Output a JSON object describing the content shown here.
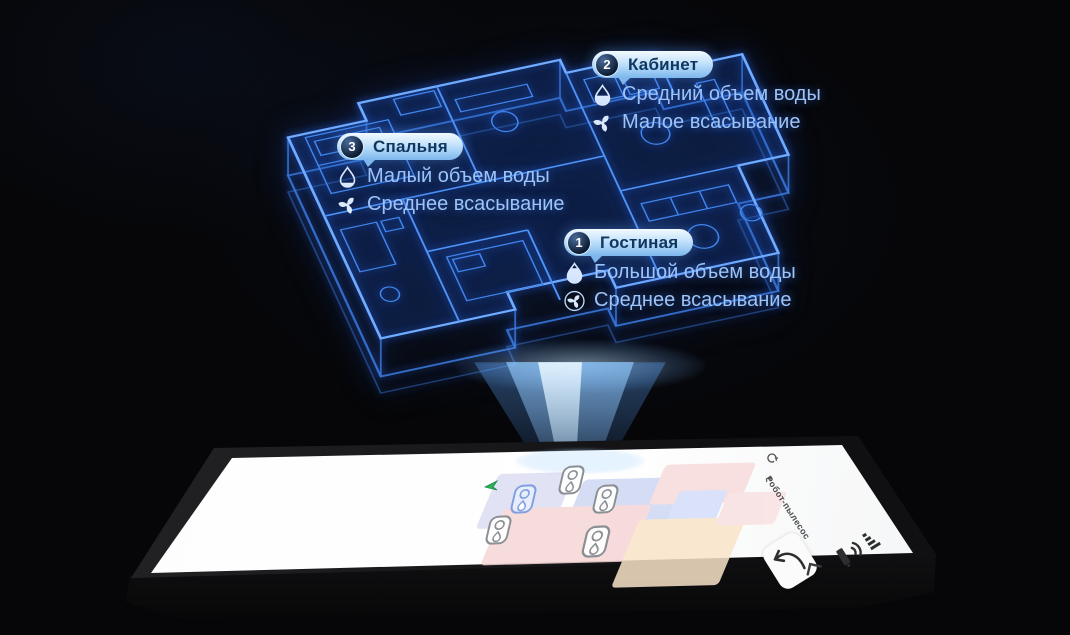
{
  "hologram": {
    "rooms": [
      {
        "number": "2",
        "name": "Кабинет",
        "water_label": "Средний объем воды",
        "suction_label": "Малое всасывание",
        "water_level": "medium",
        "suction_icon": "fan-icon"
      },
      {
        "number": "3",
        "name": "Спальня",
        "water_label": "Малый объем воды",
        "suction_label": "Среднее всасывание",
        "water_level": "small",
        "suction_icon": "fan-icon"
      },
      {
        "number": "1",
        "name": "Гостиная",
        "water_label": "Большой объем воды",
        "suction_label": "Среднее всасывание",
        "water_level": "large",
        "suction_icon": "fan-in-circle-icon"
      }
    ],
    "colors": {
      "wireframe": "#4e92f5",
      "beam": "#8fc9ff",
      "bubble_fill": "#7db7ee",
      "bubble_text": "#103760",
      "annotation_text": "#9cc4f8"
    }
  },
  "phone": {
    "app_title": "Робот-пылесос",
    "screen": {
      "map_room_colors": [
        "#dcddf3",
        "#cdd8f3",
        "#f8dbdc",
        "#f6d6d7",
        "#d4defa",
        "#fae4c9",
        "#f8e0e0"
      ],
      "room_badge_icons": [
        "suction-fan-icon",
        "water-drop-icon"
      ],
      "robot_marker_color": "#2bb45c",
      "selected_badge_color": "#7f9fe0"
    },
    "status_icons": [
      "signal-icon",
      "wifi-icon",
      "battery-icon"
    ],
    "appbar_icons": [
      "refresh-icon",
      "more-icon"
    ],
    "nav": {
      "back_icon": "chevron-left",
      "recall_button_icon": "curved-arrow"
    }
  }
}
